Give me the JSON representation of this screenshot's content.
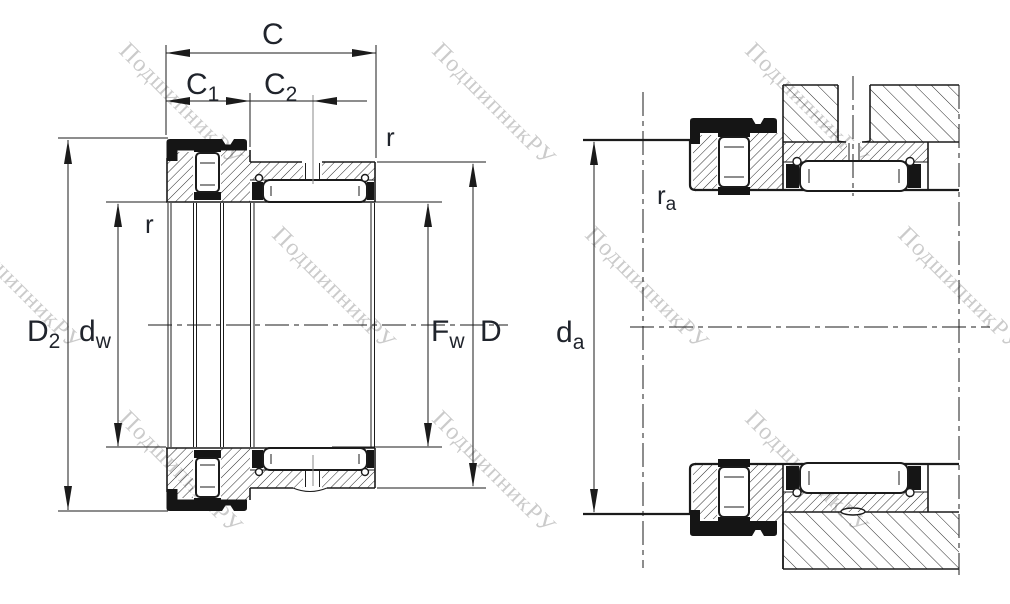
{
  "figure": {
    "type": "bearing-technical-drawing",
    "description": "Cross-section drawing of a combined needle roller / axial roller bearing (left view: bearing section with dimensions; right view: mounted arrangement with shaft and housing)",
    "watermark": {
      "text": "ПодшипникРУ",
      "color": "#cbcbcb"
    },
    "colors": {
      "line": "#1b1b1b",
      "label": "#20242c",
      "background": "#ffffff"
    },
    "labels": {
      "c": {
        "main": "C"
      },
      "c1": {
        "main": "C",
        "sub": "1"
      },
      "c2": {
        "main": "C",
        "sub": "2"
      },
      "r_outer": {
        "main": "r"
      },
      "r_inner": {
        "main": "r"
      },
      "d2": {
        "main": "D",
        "sub": "2"
      },
      "dw": {
        "main": "d",
        "sub": "w"
      },
      "fw": {
        "main": "F",
        "sub": "w"
      },
      "d": {
        "main": "D"
      },
      "da": {
        "main": "d",
        "sub": "a"
      },
      "ra": {
        "main": "r",
        "sub": "a"
      }
    }
  }
}
